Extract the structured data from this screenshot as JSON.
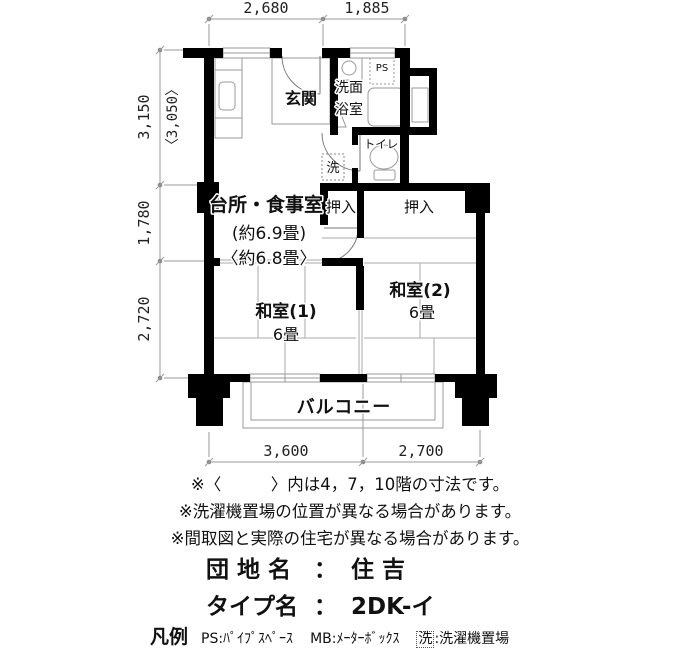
{
  "plan": {
    "dims": {
      "top": [
        "2,680",
        "1,885"
      ],
      "left_primary": "3,150",
      "left_alt": "〈3,050〉",
      "left_mid": "1,780",
      "left_bottom": "2,720",
      "bottom": [
        "3,600",
        "2,700"
      ]
    },
    "labels": {
      "genkan": "玄関",
      "washroom_1": "洗面",
      "washroom_2": "浴室",
      "ps": "PS",
      "toilet": "トイレ",
      "laundry": "洗",
      "kitchen_1": "台所・食事室",
      "kitchen_2": "(約6.9畳)",
      "kitchen_3": "〈約6.8畳〉",
      "closet_left": "押入",
      "closet_right": "押入",
      "washitsu1_1": "和室(1)",
      "washitsu1_2": "6畳",
      "washitsu2_1": "和室(2)",
      "washitsu2_2": "6畳",
      "balcony": "バルコニー"
    }
  },
  "notes": {
    "items": [
      "※〈　　　〉内は4，7，10階の寸法です。",
      "※洗濯機置場の位置が異なる場合があります。",
      "※間取図と実際の住宅が異なる場合があります。"
    ]
  },
  "property": {
    "estate_label": "団 地 名",
    "estate_colon": "：",
    "estate_value": "住 吉",
    "type_label": "タイプ名",
    "type_colon": "：",
    "type_value": "2DK-イ"
  },
  "legend": {
    "heading": "凡例",
    "ps": "PS:ﾊﾟｲﾌﾟｽﾍﾟｰｽ",
    "mb": "MB:ﾒｰﾀｰﾎﾞｯｸｽ",
    "laundry_mark": "洗",
    "laundry_rest": ":洗濯機置場"
  },
  "colors": {
    "wall": "#000000",
    "thin_line": "#999999",
    "text": "#111111"
  }
}
